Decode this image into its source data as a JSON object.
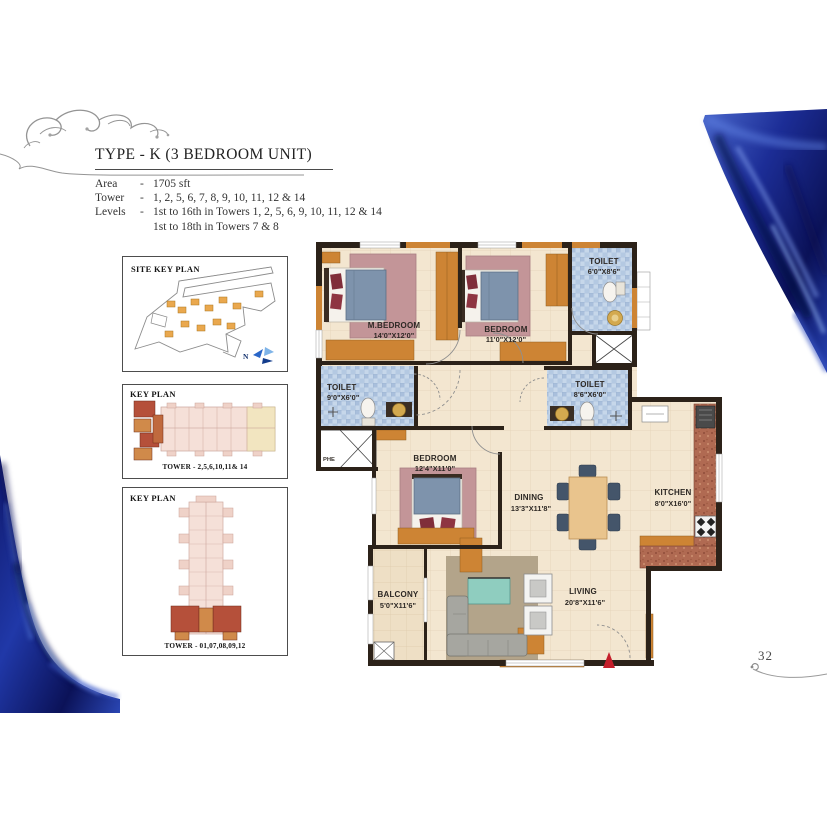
{
  "header": {
    "title": "TYPE - K (3 BEDROOM UNIT)",
    "rows": [
      {
        "label": "Area",
        "sep": "-",
        "value": "1705 sft"
      },
      {
        "label": "Tower",
        "sep": "-",
        "value": "1, 2, 5, 6, 7, 8, 9, 10, 11, 12 & 14"
      },
      {
        "label": "Levels",
        "sep": "-",
        "value": "1st to 16th in Towers 1, 2, 5, 6, 9, 10, 11, 12 & 14"
      },
      {
        "label": "",
        "sep": "",
        "value": "1st to 18th in Towers 7 & 8"
      }
    ]
  },
  "site_key_plan": {
    "title": "SITE KEY PLAN",
    "compass": "N"
  },
  "key_plan_top": {
    "title": "KEY PLAN",
    "tower_label": "TOWER - 2,5,6,10,11& 14"
  },
  "key_plan_bottom": {
    "title": "KEY PLAN",
    "tower_label": "TOWER - 01,07,08,09,12"
  },
  "floor_plan": {
    "rooms": [
      {
        "name": "M.BEDROOM",
        "dims": "14'0\"X12'0\""
      },
      {
        "name": "BEDROOM",
        "dims": "11'0\"X12'0\""
      },
      {
        "name": "TOILET",
        "dims": "6'0\"X8'6\""
      },
      {
        "name": "TOILET",
        "dims": "9'0\"X6'0\""
      },
      {
        "name": "TOILET",
        "dims": "8'6\"X6'0\""
      },
      {
        "name": "BEDROOM",
        "dims": "12'4\"X11'0\""
      },
      {
        "name": "DINING",
        "dims": "13'3\"X11'8\""
      },
      {
        "name": "KITCHEN",
        "dims": "8'0\"X16'0\""
      },
      {
        "name": "LIVING",
        "dims": "20'8\"X11'6\""
      },
      {
        "name": "BALCONY",
        "dims": "5'0\"X11'6\""
      }
    ],
    "shaft_label": "PHE"
  },
  "page": {
    "number": "32"
  },
  "colors": {
    "wall_dark": "#2c2219",
    "wood_orange": "#cd8434",
    "tile_blue": "#b6c9e2",
    "floor_cream": "#f3e6d0",
    "satin_blue": "#1e2f9e",
    "entry_arrow_red": "#c41e2a"
  }
}
